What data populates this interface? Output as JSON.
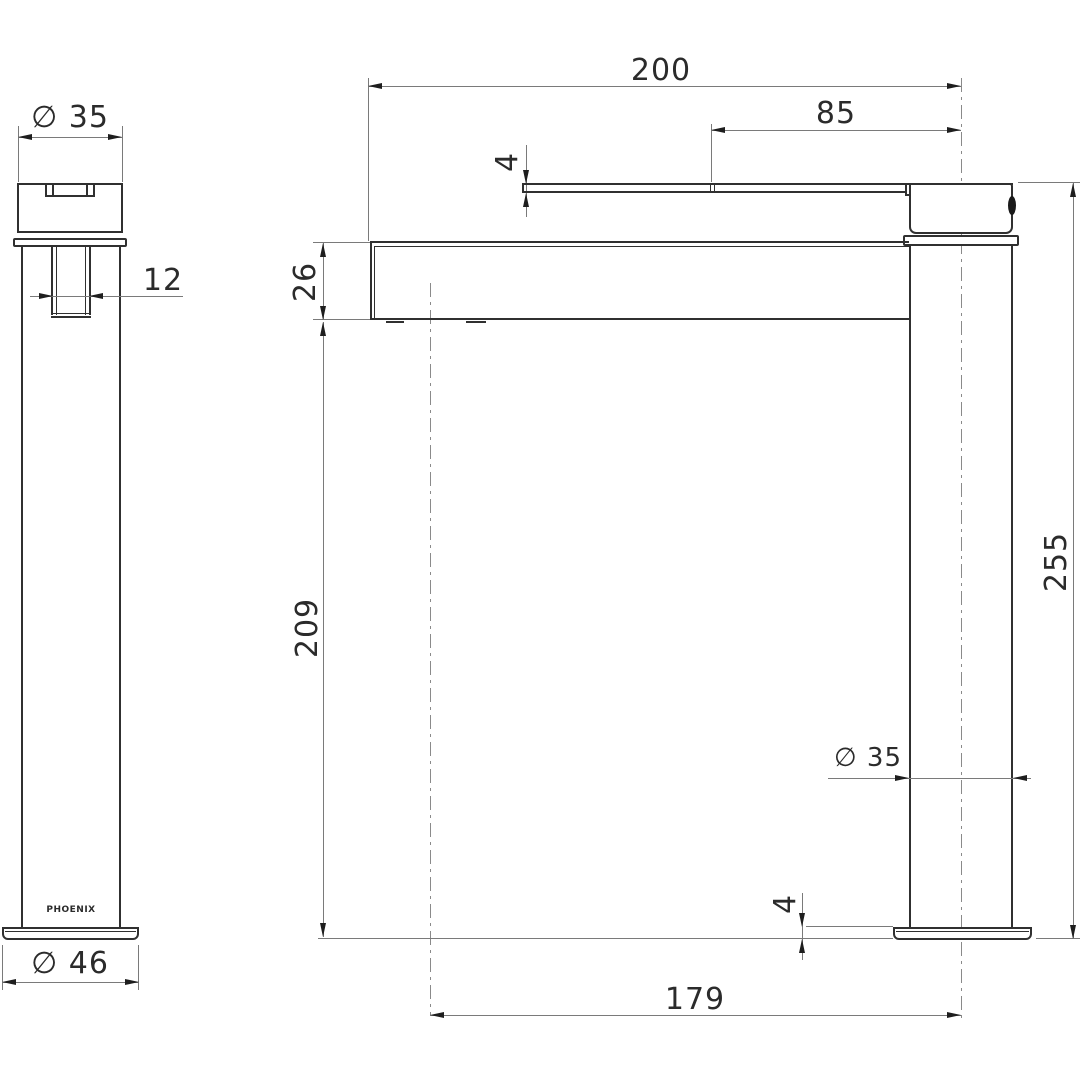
{
  "page": {
    "background": "#ffffff",
    "description": "Technical dimension drawing of a Phoenix tall basin mixer tap, side view (left) and front view (right)"
  },
  "drawing": {
    "brand_label": "PHOENIX",
    "side_view": {
      "handle_diameter": "∅ 35",
      "slot_width": "12",
      "base_diameter": "∅ 46"
    },
    "front_view": {
      "overall_projection": "200",
      "handle_length": "85",
      "handle_thickness": "4",
      "spout_depth": "26",
      "spout_clearance": "209",
      "overall_height": "255",
      "body_diameter": "∅ 35",
      "base_plate_thickness": "4",
      "spout_reach_to_center": "179"
    },
    "colors": {
      "object_line": "#303030",
      "dimension_line": "#7a7a7a",
      "text": "#2b2b2b",
      "background": "#ffffff"
    }
  }
}
